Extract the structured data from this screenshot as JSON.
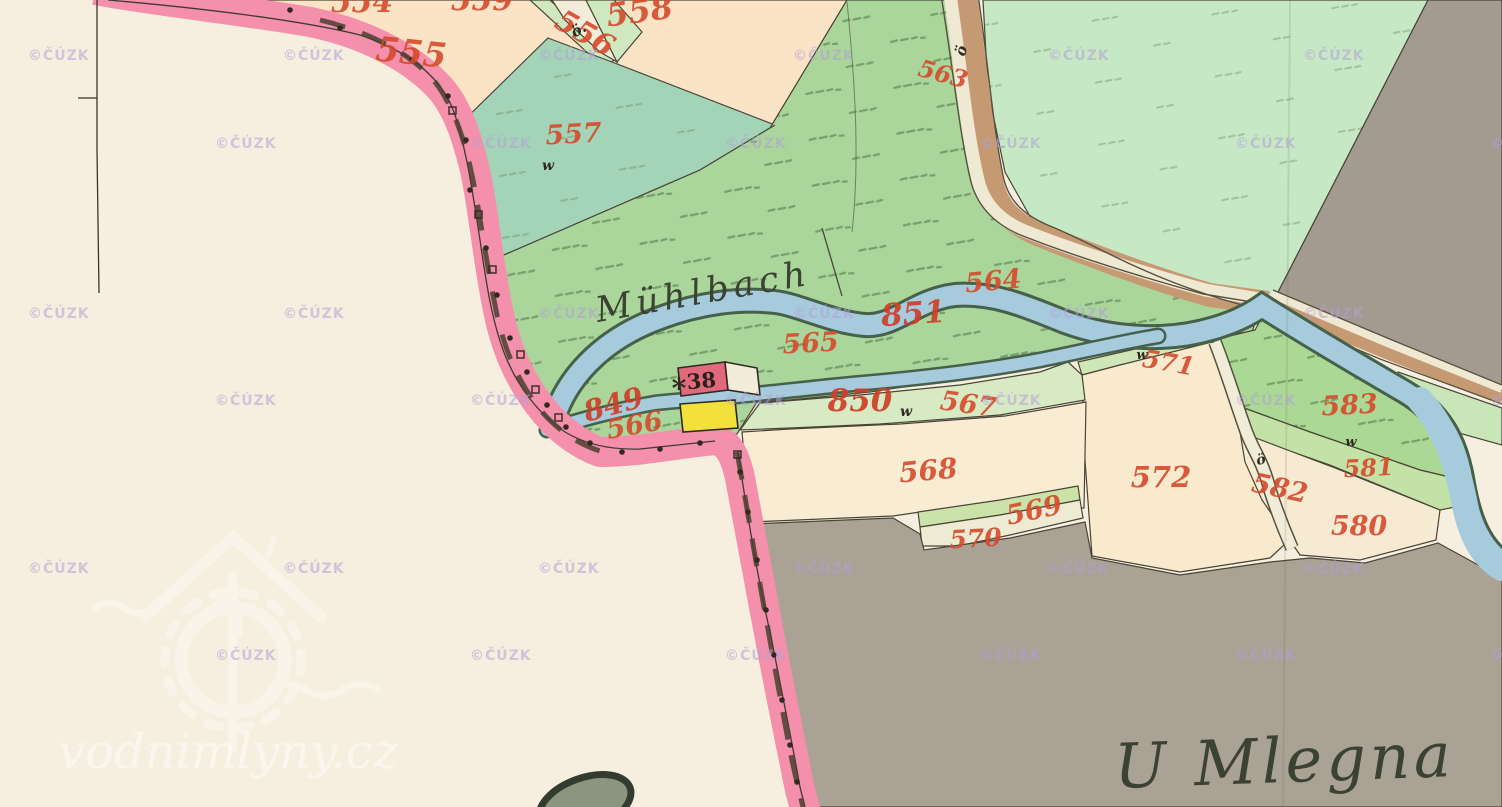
{
  "map": {
    "title": "Historical cadastral map sheet",
    "place_names": [
      {
        "text": "Mühlbach",
        "x": 598,
        "y": 322,
        "rot": -10,
        "size": 35,
        "ls": 5,
        "anchor": "start",
        "name": "stream-name-muhlbach"
      },
      {
        "text": "U Mlegna",
        "x": 1115,
        "y": 788,
        "rot": -2,
        "size": 62,
        "ls": 4,
        "anchor": "start",
        "name": "area-name-u-mlegna"
      }
    ],
    "parcel_numbers": [
      {
        "text": "554",
        "x": 362,
        "y": 12,
        "rot": 0,
        "size": 30
      },
      {
        "text": "559",
        "x": 482,
        "y": 10,
        "rot": 0,
        "size": 30
      },
      {
        "text": "558",
        "x": 641,
        "y": 22,
        "rot": -8,
        "size": 32
      },
      {
        "text": "555",
        "x": 410,
        "y": 64,
        "rot": 6,
        "size": 34
      },
      {
        "text": "556",
        "x": 580,
        "y": 42,
        "rot": 30,
        "size": 30
      },
      {
        "text": "557",
        "x": 574,
        "y": 143,
        "rot": -3,
        "size": 27
      },
      {
        "text": "563",
        "x": 941,
        "y": 82,
        "rot": 15,
        "size": 24
      },
      {
        "text": "564",
        "x": 994,
        "y": 290,
        "rot": -5,
        "size": 27
      },
      {
        "text": "565",
        "x": 811,
        "y": 352,
        "rot": -3,
        "size": 27
      },
      {
        "text": "566",
        "x": 636,
        "y": 434,
        "rot": -10,
        "size": 27
      },
      {
        "text": "567",
        "x": 967,
        "y": 413,
        "rot": 8,
        "size": 27
      },
      {
        "text": "568",
        "x": 929,
        "y": 480,
        "rot": -5,
        "size": 28
      },
      {
        "text": "569",
        "x": 1036,
        "y": 519,
        "rot": -12,
        "size": 27
      },
      {
        "text": "570",
        "x": 976,
        "y": 547,
        "rot": -3,
        "size": 25
      },
      {
        "text": "571",
        "x": 1167,
        "y": 371,
        "rot": 10,
        "size": 25
      },
      {
        "text": "572",
        "x": 1161,
        "y": 487,
        "rot": 0,
        "size": 29
      },
      {
        "text": "582",
        "x": 1278,
        "y": 497,
        "rot": 12,
        "size": 27
      },
      {
        "text": "583",
        "x": 1350,
        "y": 414,
        "rot": -3,
        "size": 27
      },
      {
        "text": "581",
        "x": 1369,
        "y": 476,
        "rot": -3,
        "size": 24
      },
      {
        "text": "580",
        "x": 1359,
        "y": 535,
        "rot": 0,
        "size": 27
      }
    ],
    "watercourse_numbers": [
      {
        "text": "851",
        "x": 914,
        "y": 324,
        "rot": -4,
        "size": 31
      },
      {
        "text": "850",
        "x": 860,
        "y": 411,
        "rot": 0,
        "size": 31
      },
      {
        "text": "849",
        "x": 616,
        "y": 414,
        "rot": -15,
        "size": 29
      }
    ],
    "building_numbers": [
      {
        "text": "38",
        "x": 702,
        "y": 388,
        "rot": -5,
        "size": 21
      }
    ],
    "symbols": [
      {
        "text": "ö.",
        "x": 581,
        "y": 34,
        "rot": -30,
        "size": 15,
        "name": "orchard-symbol"
      },
      {
        "text": "ö",
        "x": 966,
        "y": 52,
        "rot": -75,
        "size": 15,
        "name": "road-symbol"
      },
      {
        "text": "ö",
        "x": 1262,
        "y": 464,
        "rot": -15,
        "size": 14,
        "name": "path-symbol"
      },
      {
        "text": "w",
        "x": 548,
        "y": 170,
        "rot": 0,
        "size": 14,
        "name": "meadow-symbol"
      },
      {
        "text": "w",
        "x": 906,
        "y": 416,
        "rot": 0,
        "size": 14,
        "name": "meadow-symbol"
      },
      {
        "text": "w",
        "x": 1142,
        "y": 359,
        "rot": 0,
        "size": 13,
        "name": "meadow-symbol"
      },
      {
        "text": "w",
        "x": 1351,
        "y": 446,
        "rot": 0,
        "size": 13,
        "name": "meadow-symbol"
      },
      {
        "text": "*",
        "x": 679,
        "y": 398,
        "rot": 0,
        "size": 28,
        "name": "house-mark-symbol"
      }
    ],
    "watermarks": {
      "cuzk": {
        "text": "©ČÚZK",
        "color": "#b3a0d6",
        "rows": [
          60,
          148,
          318,
          405,
          573,
          660
        ],
        "cols_even": [
          28,
          283,
          538,
          793,
          1048,
          1303
        ],
        "cols_odd": [
          215,
          470,
          725,
          980,
          1235,
          1490
        ]
      },
      "brand": {
        "text": "vodnimlyny.cz",
        "x": 58,
        "y": 768,
        "size": 48
      }
    },
    "colors": {
      "paper": "#f6efdf",
      "field_peach": "#fbe4c6",
      "meadow_teal": "#a4d4b8",
      "meadow_green": "#aad69c",
      "field_east_green": "#c7e8c5",
      "green_583": "#abd894",
      "green_581": "#c3e3a6",
      "strip_567": "#d7eac4",
      "strip_569": "#cbe3a9",
      "strip_570": "#edebd3",
      "cream_568": "#f8ecd3",
      "cream_572": "#f9e9cd",
      "cream_580": "#f7ead2",
      "gray_top_right": "#a39a90",
      "gray_main": "#aaa295",
      "stream_fill": "#a6cbdd",
      "stream_edge": "#46604a",
      "road_brown": "#c59a73",
      "road_white": "#efe8d2",
      "boundary_pink": "#f490ac",
      "number_red": "#d64a2c",
      "building_red": "#e0697e",
      "building_yellow": "#f2e13c",
      "ink_black": "#3c372c"
    }
  }
}
